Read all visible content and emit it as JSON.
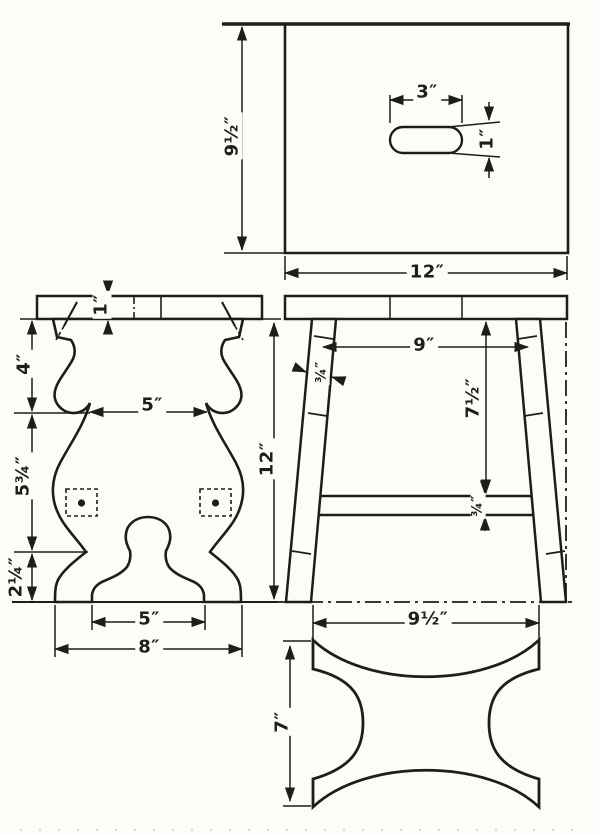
{
  "colors": {
    "paper": "#fcfcf9",
    "ink": "#1d1d1b"
  },
  "views": {
    "seat_top_view": {
      "hand_slot_length": "3″",
      "hand_slot_width": "1″",
      "seat_depth": "9½″",
      "seat_length": "12″"
    },
    "side_view": {
      "leg_span_top": "9″",
      "leg_stock_thickness": "¾″",
      "seat_to_stretcher": "7½″",
      "stretcher_thickness": "¾″",
      "leg_span_bottom": "9½″"
    },
    "end_leg_view": {
      "seat_thickness": "1″",
      "upper_section": "4″",
      "middle_section": "5¾″",
      "lower_section": "2¼″",
      "waist_width": "5″",
      "foot_arch_width": "5″",
      "base_width": "8″",
      "overall_height": "12″"
    },
    "stretcher_face_view": {
      "height": "7″"
    }
  }
}
